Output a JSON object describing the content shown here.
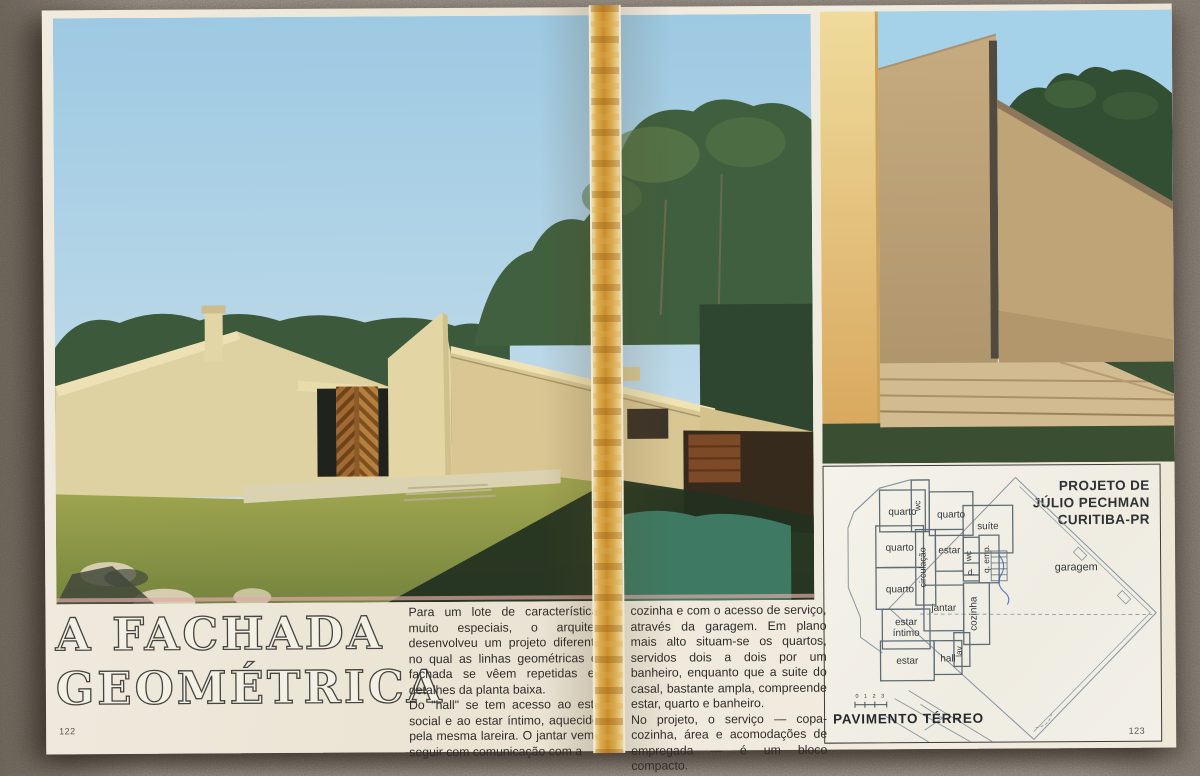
{
  "title": {
    "line1": "A FACHADA",
    "line2": "GEOMÉTRICA"
  },
  "pages": {
    "left_number": "122",
    "right_number": "123"
  },
  "article": {
    "column1_paragraph1": "Para um lote de características muito especiais, o arquiteto desenvolveu um projeto diferente, no qual as linhas geométricas da fachada se vêem repetidas em detalhes da planta baixa.",
    "column1_paragraph2": "Do \"hall\" se tem acesso ao estar social e ao estar íntimo, aquecidos pela mesma lareira. O jantar vem a seguir com comunicação com a",
    "column2_paragraph1": "cozinha e com o acesso de serviço, através da garagem. Em plano mais alto situam-se os quartos, servidos dois a dois por um banheiro, enquanto que a suite do casal, bastante ampla, compreende estar, quarto e banheiro.",
    "column2_paragraph2": "No projeto, o serviço — copa-cozinha, área e acomodações de empregada — é um bloco compacto."
  },
  "credit": {
    "line1": "PROJETO DE",
    "line2": "JÚLIO PECHMAN",
    "line3": "CURITIBA-PR"
  },
  "plan": {
    "caption": "PAVIMENTO TÉRREO",
    "scale": "0 1 2 3",
    "rooms": {
      "quarto1": "quarto",
      "wc1": "wc",
      "quarto2": "quarto",
      "suite": "suíte",
      "quarto3": "quarto",
      "circulacao": "circulação",
      "estar1": "estar",
      "wc2": "wc",
      "qemp": "q. emp.",
      "d": "d.",
      "quarto4": "quarto",
      "jantar": "jantar",
      "cozinha": "cozinha",
      "estar_intimo_a": "estar",
      "estar_intimo_b": "íntimo",
      "estar2": "estar",
      "hall": "hall",
      "lav": "lav",
      "garagem": "garagem"
    }
  },
  "colors": {
    "paper": "#efe9dc",
    "spine_tape": "#d9a94e",
    "sky": "#a9cfe4",
    "house_cream": "#ded0a0",
    "grass": "#8e9a49",
    "grass_shadow": "#24341f",
    "teal_grass": "#3e7a63",
    "plan_line": "#84949e",
    "background_surface": "#8d8175"
  }
}
